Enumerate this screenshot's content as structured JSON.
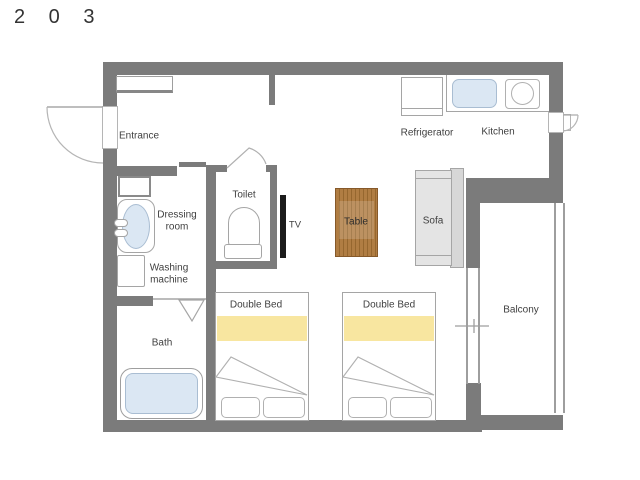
{
  "title": "2 0 3",
  "colors": {
    "wall": "#7b7b7b",
    "line": "#9e9e9e",
    "water": "#dbe7f3",
    "waterline": "#a9bdd2",
    "yellow": "#f8e6a0",
    "wood": "#b07d43",
    "wooddark": "#96672f",
    "woodborder": "#86592a",
    "sofa": "#e4e4e4",
    "sofaback": "#d7d7d7",
    "tv": "#1b1b1b",
    "text": "#3f3f3f"
  },
  "rooms": {
    "entrance": "Entrance",
    "kitchen": "Kitchen",
    "toilet": "Toilet",
    "dressing_room": "Dressing room",
    "bath": "Bath",
    "balcony": "Balcony"
  },
  "fixtures": {
    "refrigerator": "Refrigerator",
    "washing_machine": "Washing machine",
    "tv": "TV",
    "table": "Table",
    "sofa": "Sofa",
    "double_bed_1": "Double Bed",
    "double_bed_2": "Double Bed"
  }
}
